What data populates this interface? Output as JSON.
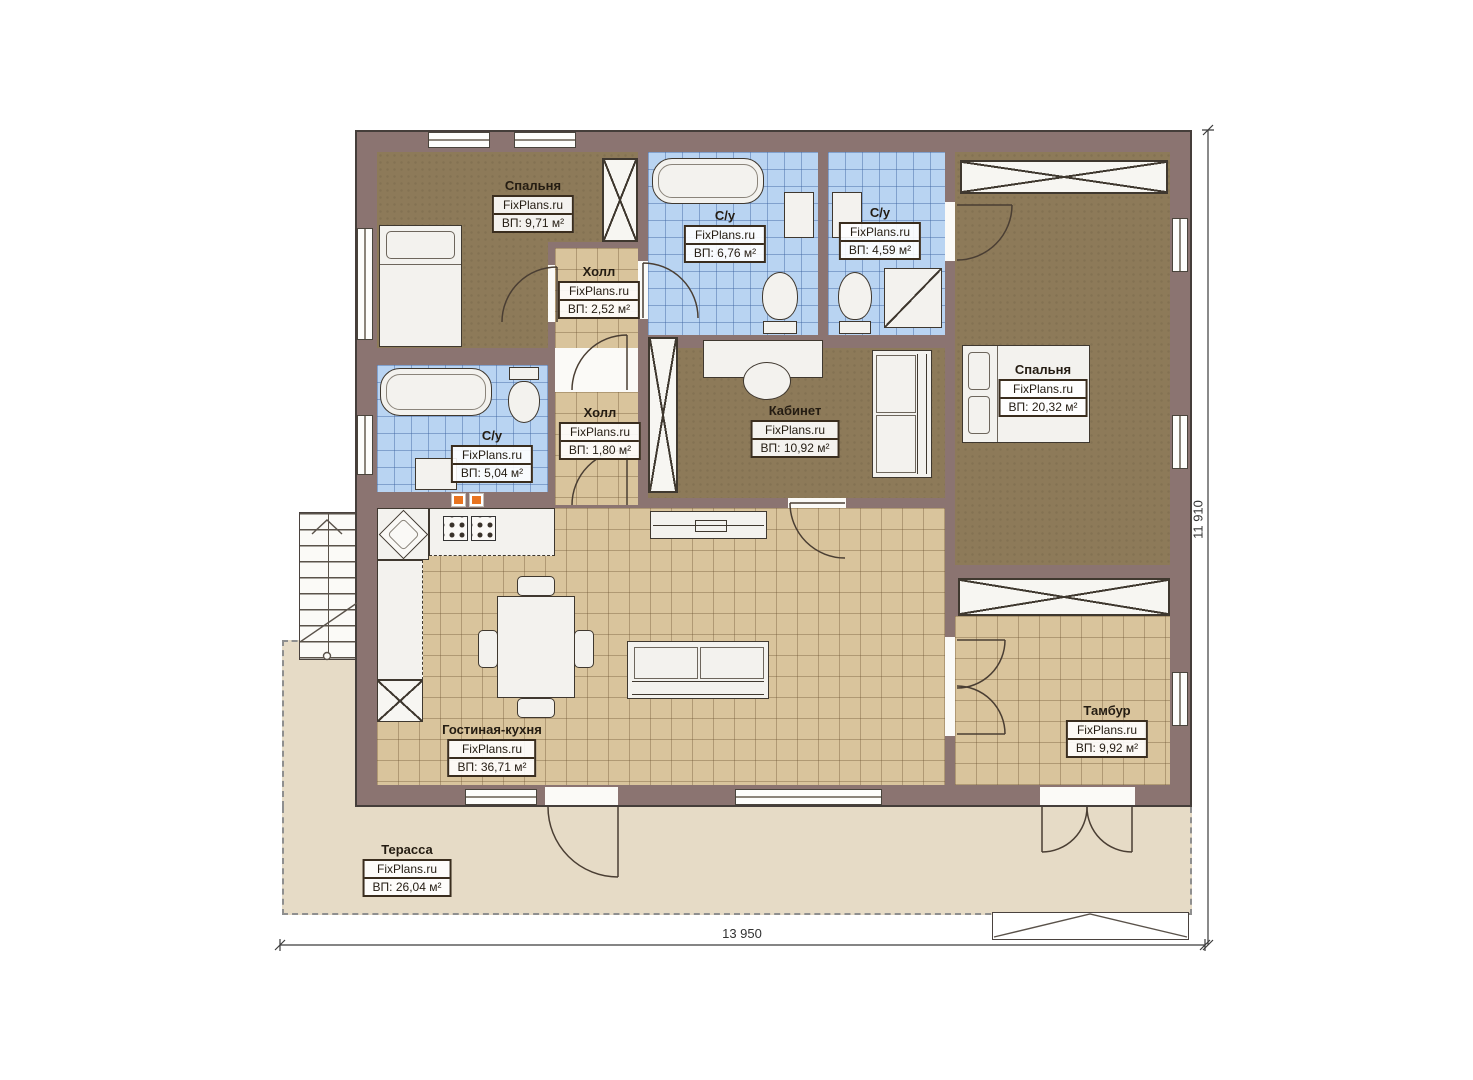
{
  "plan": {
    "watermark": "FixPlans.ru",
    "dimensions": {
      "width_label": "13 950",
      "height_label": "11 910"
    },
    "colors": {
      "wall": "#8b7471",
      "floor_brown": "#8d7a59",
      "floor_tile_beige": "#d9c49c",
      "floor_tile_blue": "#b9d4f2",
      "terrace": "#e6dbc6",
      "accent_orange": "#e87420"
    },
    "rooms": [
      {
        "name": "Спальня",
        "area": "ВП: 9,71 м²"
      },
      {
        "name": "С/у",
        "area": "ВП: 6,76 м²"
      },
      {
        "name": "С/у",
        "area": "ВП: 4,59 м²"
      },
      {
        "name": "Холл",
        "area": "ВП: 2,52 м²"
      },
      {
        "name": "Спальня",
        "area": "ВП: 20,32 м²"
      },
      {
        "name": "С/у",
        "area": "ВП: 5,04 м²"
      },
      {
        "name": "Холл",
        "area": "ВП: 1,80 м²"
      },
      {
        "name": "Кабинет",
        "area": "ВП: 10,92 м²"
      },
      {
        "name": "Гостиная-кухня",
        "area": "ВП: 36,71 м²"
      },
      {
        "name": "Тамбур",
        "area": "ВП: 9,92 м²"
      },
      {
        "name": "Терасса",
        "area": "ВП: 26,04 м²"
      }
    ]
  }
}
